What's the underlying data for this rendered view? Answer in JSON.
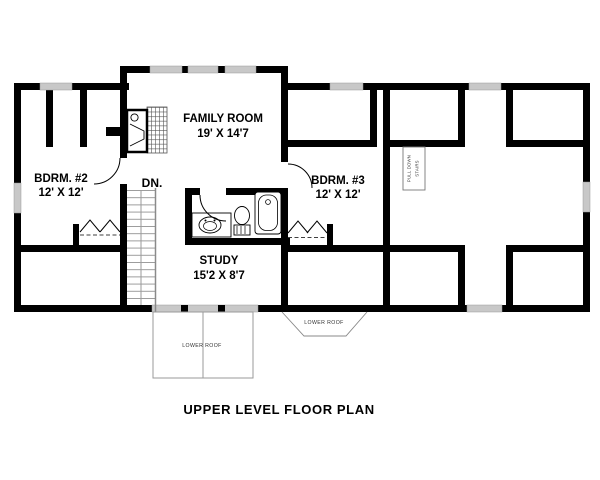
{
  "drawing": {
    "title": "UPPER LEVEL FLOOR PLAN",
    "rooms": {
      "family_room": {
        "name": "FAMILY ROOM",
        "dims": "19' X 14'7"
      },
      "bedroom_2": {
        "name": "BDRM. #2",
        "dims": "12' X 12'"
      },
      "bedroom_3": {
        "name": "BDRM. #3",
        "dims": "12' X 12'"
      },
      "study": {
        "name": "STUDY",
        "dims": "15'2 X 8'7"
      }
    },
    "annotations": {
      "stairs_down": "DN.",
      "pull_down_stairs": [
        "PULL DOWN",
        "STAIRS"
      ],
      "lower_roof_deck": "LOWER ROOF",
      "lower_roof_bay": "LOWER ROOF"
    },
    "colors": {
      "wall": "#000000",
      "window": "#c8c8c8",
      "thin_line": "#8a8a8a",
      "text": "#000000",
      "background": "#ffffff"
    }
  }
}
